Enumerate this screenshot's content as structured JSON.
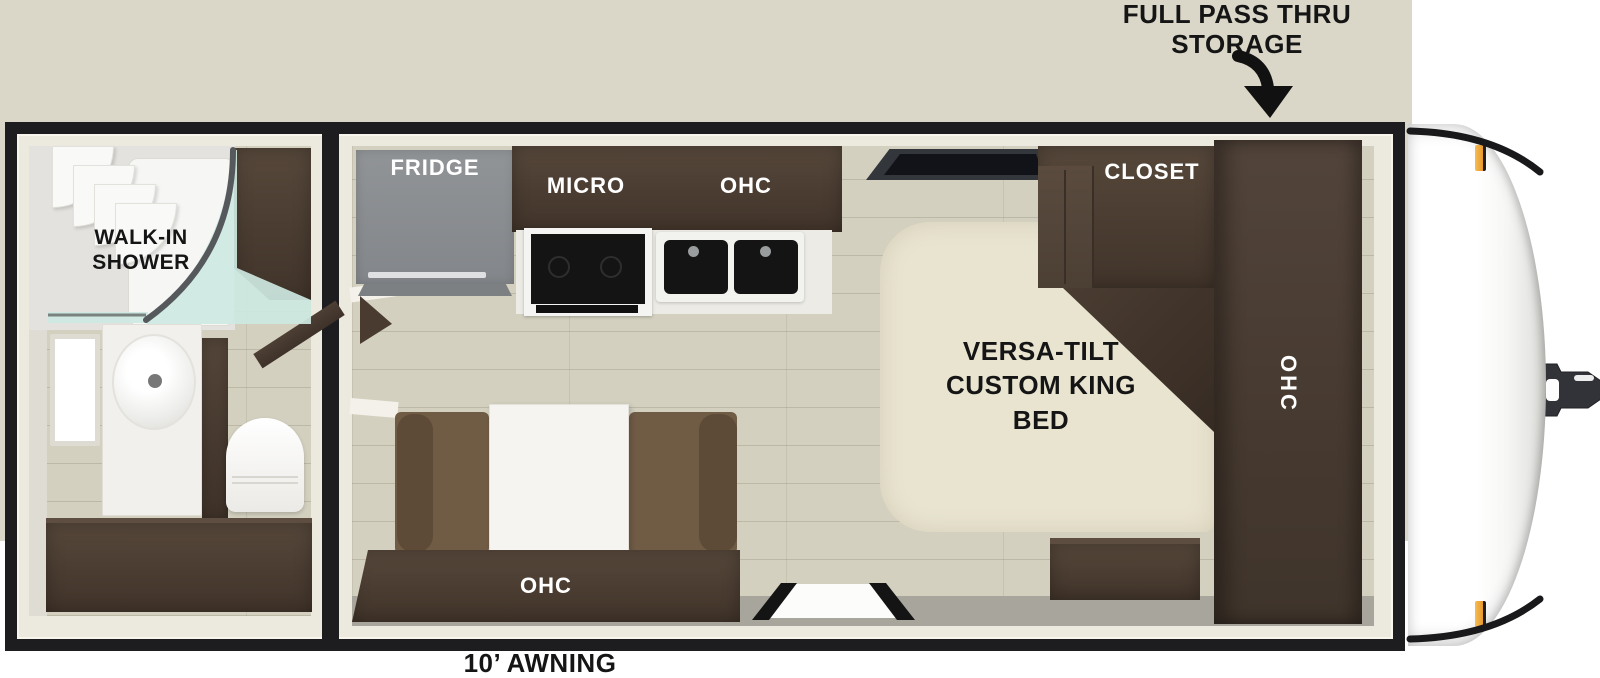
{
  "annotations": {
    "storage_label": "FULL PASS THRU STORAGE",
    "awning_label": "10’ AWNING"
  },
  "bathroom": {
    "shower_label": "WALK-IN SHOWER"
  },
  "kitchen": {
    "fridge_label": "FRIDGE",
    "micro_label": "MICRO",
    "ohc_label": "OHC"
  },
  "bedroom": {
    "closet_label": "CLOSET",
    "bed_label": "VERSA-TILT CUSTOM KING BED",
    "ohc_label": "OHC"
  },
  "living_area": {
    "ohc_label": "OHC"
  },
  "colors": {
    "wall": "#1d1d1f",
    "exterior_trim": "#dbd7c8",
    "interior_trim": "#eceadf",
    "floor": "#d3d0bf",
    "cabinet_wood": "#4a3c31",
    "fridge_gray": "#8b8e90",
    "bed_cream": "#e9e4d0",
    "sofa_brown": "#6e5a43",
    "shower_glass_teal": "#cde8e1",
    "marker_light_orange": "#f0a23c",
    "label_black": "#151515",
    "label_white": "#ffffff"
  }
}
